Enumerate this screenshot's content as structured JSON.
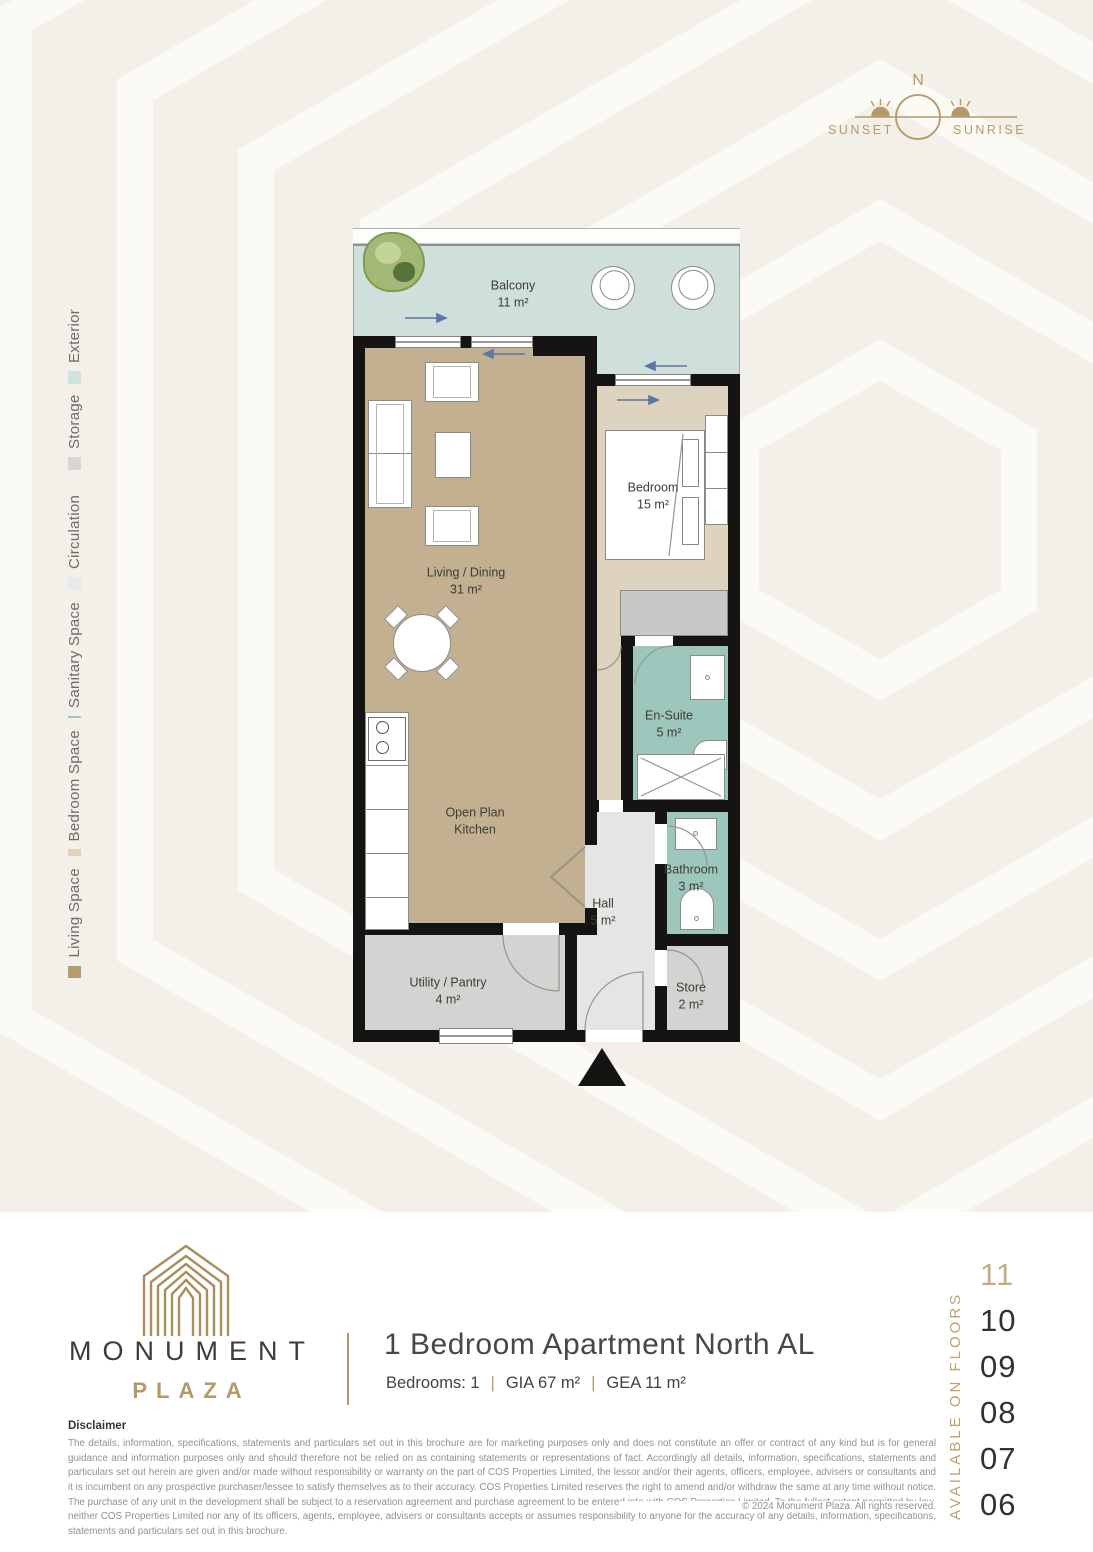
{
  "palette": {
    "page_top_bg": "#f3f0e9",
    "page_bottom_bg": "#ffffff",
    "gold": "#b49a68",
    "text_dark": "#3f3b36",
    "wall": "#161412",
    "living": "#c3b091",
    "bedroom": "#ddd3bf",
    "sanitary": "#9dc7bc",
    "circulation": "#e5e5e3",
    "storage": "#d3d3d1",
    "exterior": "#cfe0dc"
  },
  "compass": {
    "north": "N",
    "sunset": "SUNSET",
    "sunrise": "SUNRISE"
  },
  "legend": {
    "items": [
      {
        "label": "Exterior",
        "color": "#cfe2de"
      },
      {
        "label": "Storage",
        "color": "#d6d6d4"
      },
      {
        "label": "Circulation",
        "color": "#e9e9eb"
      },
      {
        "label": "Sanitary Space",
        "color": "#9fc9bf"
      },
      {
        "label": "Bedroom Space",
        "color": "#ded2b8"
      },
      {
        "label": "Living Space",
        "color": "#b59d72"
      }
    ]
  },
  "floorplan": {
    "rooms": [
      {
        "name": "Balcony",
        "area": "11 m²"
      },
      {
        "name": "Living / Dining",
        "area": "31 m²"
      },
      {
        "name": "Open Plan Kitchen",
        "area": ""
      },
      {
        "name": "Bedroom",
        "area": "15 m²"
      },
      {
        "name": "En-Suite",
        "area": "5 m²"
      },
      {
        "name": "Hall",
        "area": "5 m²"
      },
      {
        "name": "Bathroom",
        "area": "3 m²"
      },
      {
        "name": "Store",
        "area": "2 m²"
      },
      {
        "name": "Utility / Pantry",
        "area": "4 m²"
      }
    ]
  },
  "branding": {
    "name": "MONUMENT",
    "subname": "PLAZA"
  },
  "unit": {
    "title": "1 Bedroom Apartment North AL",
    "spec_bedrooms": "Bedrooms: 1",
    "spec_gia": "GIA 67 m²",
    "spec_gea": "GEA 11 m²",
    "separator": "|"
  },
  "availability": {
    "heading": "AVAILABLE ON FLOORS",
    "floors": [
      "11",
      "10",
      "09",
      "08",
      "07",
      "06"
    ],
    "highlighted_floor": "11"
  },
  "disclaimer": {
    "heading": "Disclaimer",
    "body": "The details, information, specifications, statements and particulars set out in this brochure are for marketing purposes only and does not constitute an offer or contract of any kind but is for general guidance and information purposes only and should therefore not be relied on as containing statements or representations of fact. Accordingly all details, information, specifications, statements and particulars set out herein are given and/or made without responsibility or warranty on the part of COS Properties Limited, the lessor and/or their agents, officers, employee, advisers or consultants and it is incumbent on any prospective purchaser/lessee to satisfy themselves as to their accuracy. COS Properties Limited reserves the right to amend and/or withdraw the same at any time without notice. The purchase of any unit in the development shall be subject to a reservation agreement and purchase agreement to be entered into with COS Properties Limited. To the fullest extent permitted by law, neither COS Properties Limited nor any of its officers, agents, employee, advisers or consultants accepts or assumes responsibility to anyone for the accuracy of any details, information, specifications, statements and particulars set out in this brochure.",
    "copyright": "© 2024  Monument Plaza. All rights reserved."
  }
}
